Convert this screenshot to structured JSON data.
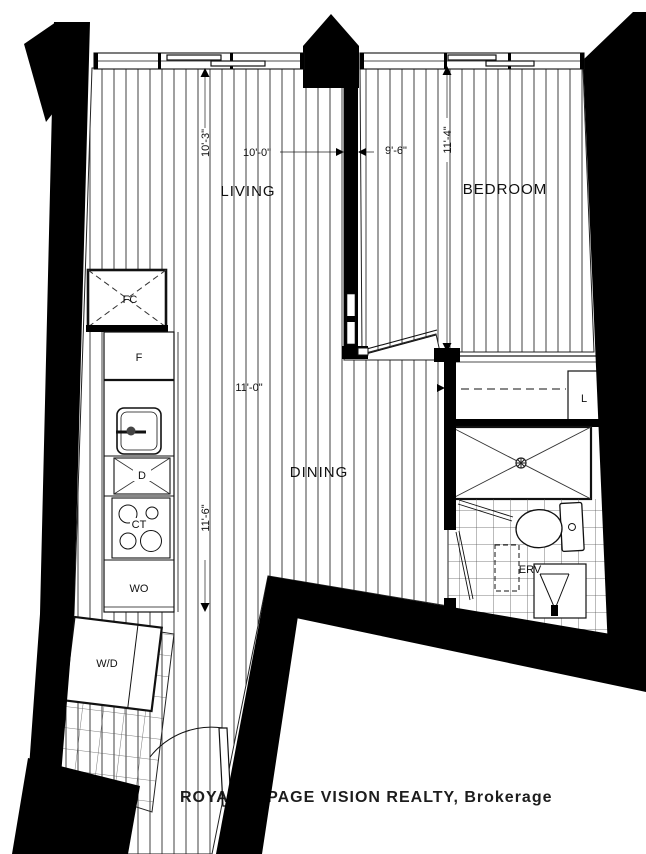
{
  "plan": {
    "watermark": "ROYAL LEPAGE VISION REALTY, Brokerage",
    "rooms": {
      "living": {
        "label": "LIVING",
        "width": "10'-0\"",
        "height": "10'-3\""
      },
      "bedroom": {
        "label": "BEDROOM",
        "width": "9'-6\"",
        "height": "11'-4\""
      },
      "dining": {
        "label": "DINING",
        "width": "11'-0\"",
        "height": "11'-6\""
      }
    },
    "kitchen": {
      "fan_coil": "FC",
      "fridge": "F",
      "dishwasher": "D",
      "cooktop": "CT",
      "wall_oven": "WO",
      "washer_dryer": "W/D"
    },
    "bathroom": {
      "erv": "ERV"
    },
    "closet": {
      "linen": "L"
    },
    "colors": {
      "wall": "#000000",
      "line": "#111111",
      "hatch": "#2b2b2b",
      "tile": "#555555",
      "watermark": "#c8c8c8",
      "label_gray": "#9b9b9b"
    }
  }
}
